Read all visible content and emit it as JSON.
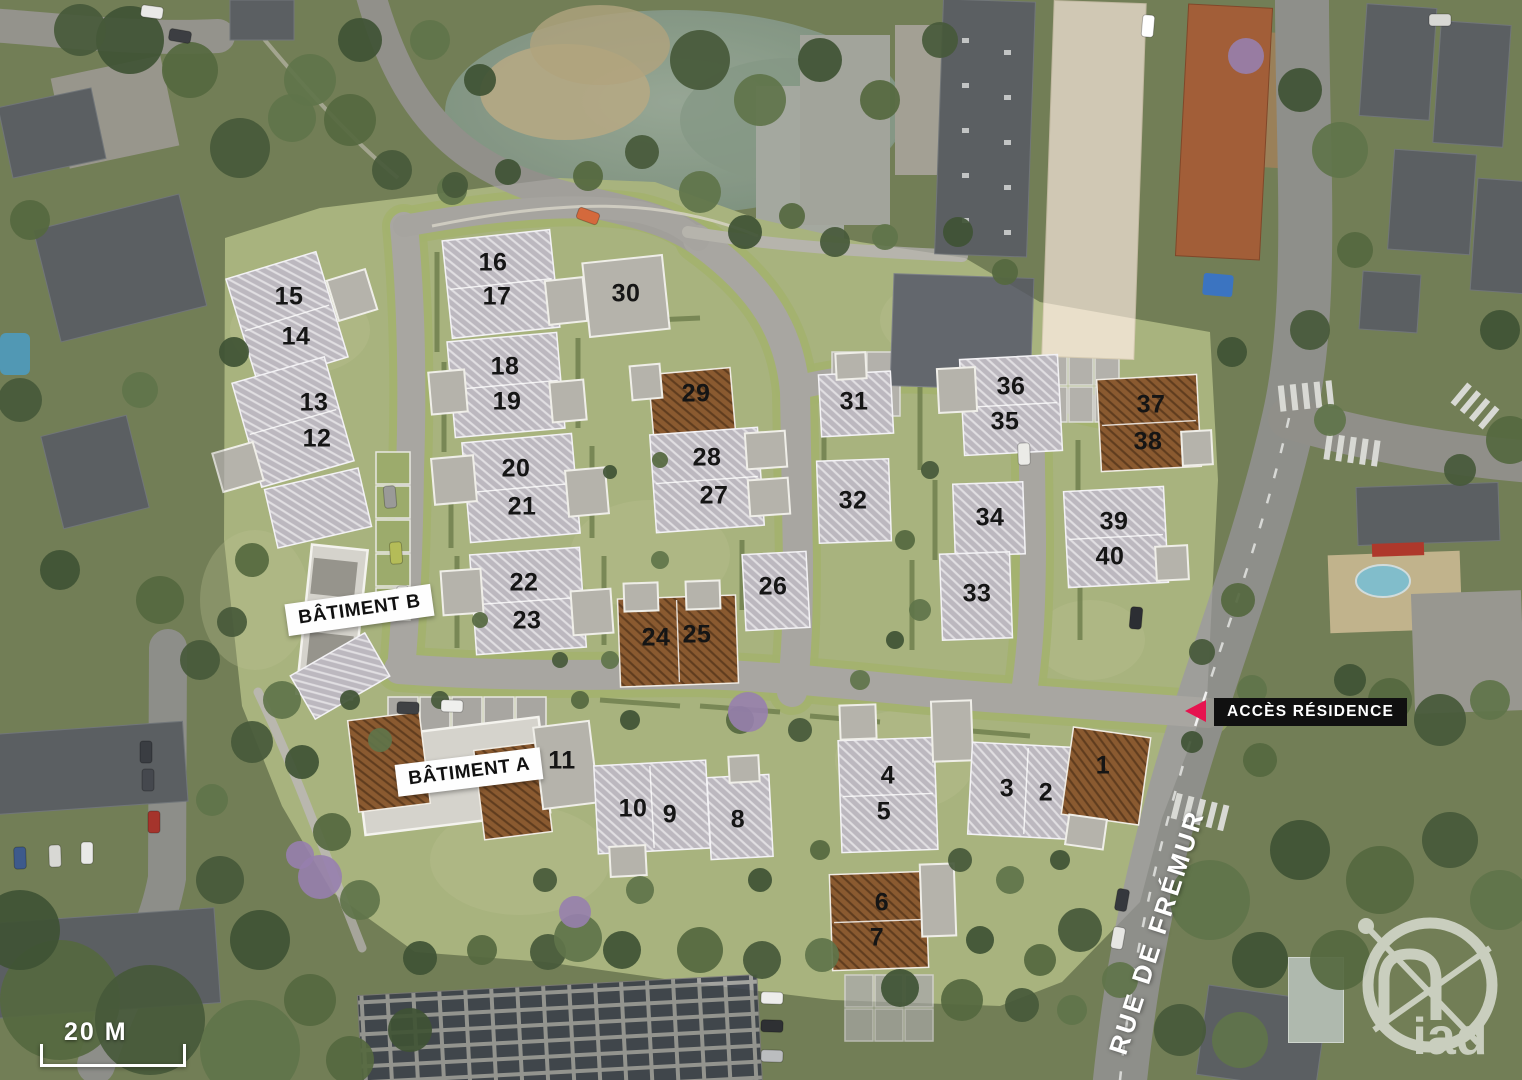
{
  "site_plan": {
    "title_labels": {
      "batiment_a": "BÂTIMENT A",
      "batiment_b": "BÂTIMENT B",
      "access_residence": "ACCÈS RÉSIDENCE",
      "street_name": "RUE DE FRÉMUR",
      "scale_label": "20 M",
      "brand": "iad"
    },
    "colors": {
      "accent_pink": "#e6134f",
      "roof_gray": "#bcb8bf",
      "roof_brown": "#8a5a30",
      "lawn_green": "#a8b37e"
    },
    "lots": [
      {
        "num": "1",
        "x": 1103,
        "y": 766,
        "roof": "brown"
      },
      {
        "num": "2",
        "x": 1046,
        "y": 793,
        "roof": "gray"
      },
      {
        "num": "3",
        "x": 1007,
        "y": 789,
        "roof": "gray"
      },
      {
        "num": "4",
        "x": 888,
        "y": 776,
        "roof": "gray"
      },
      {
        "num": "5",
        "x": 884,
        "y": 812,
        "roof": "gray"
      },
      {
        "num": "6",
        "x": 882,
        "y": 903,
        "roof": "brown"
      },
      {
        "num": "7",
        "x": 877,
        "y": 938,
        "roof": "brown"
      },
      {
        "num": "8",
        "x": 738,
        "y": 820,
        "roof": "gray"
      },
      {
        "num": "9",
        "x": 670,
        "y": 815,
        "roof": "gray"
      },
      {
        "num": "10",
        "x": 633,
        "y": 809,
        "roof": "gray"
      },
      {
        "num": "11",
        "x": 562,
        "y": 761,
        "roof": "gray"
      },
      {
        "num": "12",
        "x": 317,
        "y": 439,
        "roof": "gray"
      },
      {
        "num": "13",
        "x": 314,
        "y": 403,
        "roof": "gray"
      },
      {
        "num": "14",
        "x": 296,
        "y": 337,
        "roof": "gray"
      },
      {
        "num": "15",
        "x": 289,
        "y": 297,
        "roof": "gray"
      },
      {
        "num": "16",
        "x": 493,
        "y": 263,
        "roof": "gray"
      },
      {
        "num": "17",
        "x": 497,
        "y": 297,
        "roof": "gray"
      },
      {
        "num": "18",
        "x": 505,
        "y": 367,
        "roof": "gray"
      },
      {
        "num": "19",
        "x": 507,
        "y": 402,
        "roof": "gray"
      },
      {
        "num": "20",
        "x": 516,
        "y": 469,
        "roof": "gray"
      },
      {
        "num": "21",
        "x": 522,
        "y": 507,
        "roof": "gray"
      },
      {
        "num": "22",
        "x": 524,
        "y": 583,
        "roof": "gray"
      },
      {
        "num": "23",
        "x": 527,
        "y": 621,
        "roof": "gray"
      },
      {
        "num": "24",
        "x": 656,
        "y": 638,
        "roof": "brown"
      },
      {
        "num": "25",
        "x": 697,
        "y": 635,
        "roof": "brown"
      },
      {
        "num": "26",
        "x": 773,
        "y": 587,
        "roof": "gray"
      },
      {
        "num": "27",
        "x": 714,
        "y": 496,
        "roof": "gray"
      },
      {
        "num": "28",
        "x": 707,
        "y": 458,
        "roof": "gray"
      },
      {
        "num": "29",
        "x": 696,
        "y": 394,
        "roof": "brown"
      },
      {
        "num": "30",
        "x": 626,
        "y": 294,
        "roof": "gray"
      },
      {
        "num": "31",
        "x": 854,
        "y": 402,
        "roof": "gray"
      },
      {
        "num": "32",
        "x": 853,
        "y": 501,
        "roof": "gray"
      },
      {
        "num": "33",
        "x": 977,
        "y": 594,
        "roof": "gray"
      },
      {
        "num": "34",
        "x": 990,
        "y": 518,
        "roof": "gray"
      },
      {
        "num": "35",
        "x": 1005,
        "y": 422,
        "roof": "gray"
      },
      {
        "num": "36",
        "x": 1011,
        "y": 387,
        "roof": "gray"
      },
      {
        "num": "37",
        "x": 1151,
        "y": 405,
        "roof": "brown"
      },
      {
        "num": "38",
        "x": 1148,
        "y": 442,
        "roof": "brown"
      },
      {
        "num": "39",
        "x": 1114,
        "y": 522,
        "roof": "gray"
      },
      {
        "num": "40",
        "x": 1110,
        "y": 557,
        "roof": "gray"
      }
    ]
  }
}
